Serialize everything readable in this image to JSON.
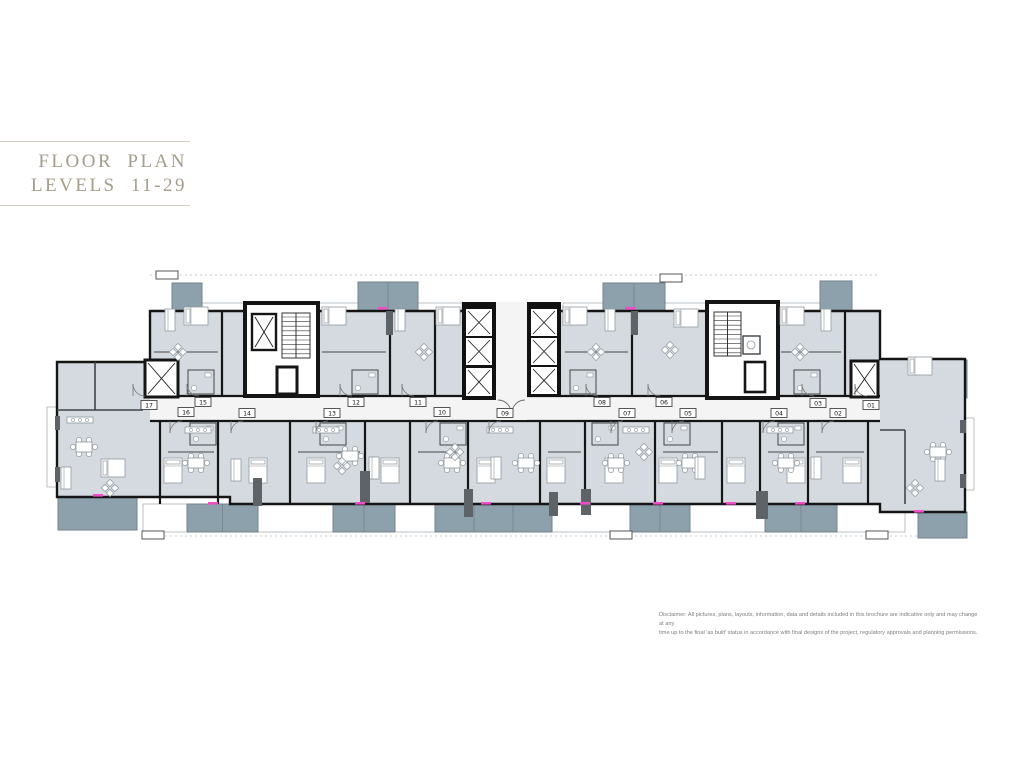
{
  "title": {
    "line1": "FLOOR  PLAN",
    "line2": "LEVELS 11-29"
  },
  "disclaimer": {
    "line1": "Disclaimer: All pictures, plans, layouts, information, data and details included in this brochure are indicative only and may change at any",
    "line2": "time up to the final 'as built' status in accordance with final designs of the project, regulatory approvals and planning permissions."
  },
  "colors": {
    "wall": "#151515",
    "room": "#d5dae0",
    "corridor": "#f4f4f5",
    "balcony": "#8da1ad",
    "balcony_edge": "#75838c",
    "white": "#ffffff",
    "thin_wall": "#3f4549",
    "furniture": "#8f989e",
    "pillar": "#5d6367",
    "pink": "#f04ec6",
    "title": "#a59c8b",
    "title_line": "#d5cec0",
    "disclaimer": "#7d7d7d",
    "dash": "#c6c9cb",
    "ledge_edge": "#aab2b7"
  },
  "plan": {
    "outline": "M150,311 H880 V359 H965 V512 H880 V504 H230 V497 H57 V362 H150 Z",
    "corridor": [
      150,
      396,
      730,
      25
    ],
    "dash_lines": [
      [
        150,
        275,
        880,
        275
      ],
      [
        145,
        536,
        965,
        536
      ]
    ],
    "walls_v_north": [
      222,
      390,
      435,
      632,
      845
    ],
    "walls_v_south": [
      160,
      218,
      290,
      365,
      410,
      468,
      540,
      585,
      655,
      722,
      760,
      808,
      868
    ],
    "walls_extra": [
      [
        57,
        410,
        143,
        410
      ],
      [
        95,
        362,
        95,
        410
      ],
      [
        905,
        430,
        905,
        504
      ],
      [
        880,
        430,
        905,
        430
      ]
    ],
    "partitions_h": [
      [
        154,
        352,
        218
      ],
      [
        322,
        352,
        386
      ],
      [
        565,
        352,
        628
      ],
      [
        781,
        352,
        841
      ],
      [
        168,
        452,
        214
      ],
      [
        298,
        452,
        360
      ],
      [
        418,
        452,
        464
      ],
      [
        548,
        452,
        581
      ],
      [
        663,
        452,
        718
      ],
      [
        768,
        452,
        804
      ],
      [
        816,
        452,
        864
      ]
    ],
    "baths": [
      [
        188,
        370,
        26,
        24
      ],
      [
        352,
        370,
        26,
        24
      ],
      [
        570,
        370,
        26,
        24
      ],
      [
        794,
        370,
        26,
        24
      ],
      [
        190,
        423,
        26,
        22
      ],
      [
        320,
        423,
        26,
        22
      ],
      [
        440,
        423,
        26,
        22
      ],
      [
        592,
        423,
        26,
        22
      ],
      [
        664,
        423,
        26,
        22
      ],
      [
        778,
        423,
        26,
        22
      ]
    ],
    "top_balconies": [
      [
        172,
        283,
        30,
        28,
        0
      ],
      [
        358,
        282,
        60,
        29,
        1
      ],
      [
        603,
        283,
        62,
        28,
        1
      ],
      [
        820,
        281,
        32,
        30,
        0
      ]
    ],
    "side_balconies": [
      [
        57,
        363,
        13,
        35
      ],
      [
        952,
        360,
        15,
        38
      ]
    ],
    "side_ledges": [
      [
        47,
        407,
        10,
        80
      ],
      [
        964,
        418,
        10,
        72
      ]
    ],
    "bottom_balconies": [
      [
        58,
        497,
        79,
        33,
        0
      ],
      [
        187,
        504,
        71,
        28,
        1
      ],
      [
        333,
        504,
        62,
        28,
        1
      ],
      [
        435,
        504,
        117,
        28,
        2
      ],
      [
        630,
        504,
        60,
        28,
        1
      ],
      [
        765,
        504,
        72,
        28,
        1
      ],
      [
        918,
        512,
        49,
        26,
        0
      ]
    ],
    "top_ledges": [
      [
        202,
        303,
        45,
        8
      ],
      [
        317,
        303,
        41,
        8
      ],
      [
        418,
        303,
        44,
        8
      ],
      [
        563,
        303,
        42,
        8
      ],
      [
        665,
        303,
        43,
        8
      ],
      [
        778,
        303,
        42,
        8
      ]
    ],
    "bottom_ledges": [
      [
        143,
        504,
        44,
        28
      ],
      [
        258,
        504,
        75,
        28
      ],
      [
        395,
        504,
        40,
        28
      ],
      [
        552,
        504,
        78,
        28
      ],
      [
        690,
        504,
        75,
        28
      ],
      [
        837,
        504,
        68,
        28
      ]
    ],
    "markers": [
      [
        156,
        271,
        22,
        8
      ],
      [
        660,
        274,
        22,
        8
      ],
      [
        142,
        531,
        22,
        8
      ],
      [
        610,
        531,
        22,
        8
      ],
      [
        866,
        531,
        22,
        8
      ]
    ],
    "cores": {
      "private_lift": [
        145,
        360,
        33,
        37
      ],
      "east_lift": [
        851,
        361,
        27,
        36
      ],
      "coreL": {
        "frame": [
          245,
          303,
          73,
          93
        ],
        "xcell": [
          252,
          314,
          24,
          36
        ],
        "stair": [
          282,
          313,
          28,
          45
        ],
        "shaft": [
          277,
          367,
          20,
          27
        ]
      },
      "towerL": {
        "frame": [
          462,
          302,
          34,
          98
        ],
        "cells": [
          [
            466,
            309,
            26,
            27
          ],
          [
            466,
            338,
            26,
            27
          ],
          [
            466,
            368,
            26,
            28
          ]
        ]
      },
      "towerR": {
        "frame": [
          527,
          302,
          34,
          95
        ],
        "cells": [
          [
            531,
            309,
            26,
            27
          ],
          [
            531,
            338,
            26,
            27
          ],
          [
            531,
            367,
            26,
            27
          ]
        ]
      },
      "lobby": [
        496,
        302,
        31,
        118
      ],
      "coreR": {
        "frame": [
          707,
          302,
          71,
          96
        ],
        "stair": [
          714,
          312,
          27,
          44
        ],
        "wc": [
          743,
          336,
          17,
          18
        ],
        "shaft": [
          745,
          362,
          20,
          30
        ]
      }
    },
    "pillars": [
      [
        386,
        311,
        7,
        24
      ],
      [
        631,
        311,
        7,
        24
      ],
      [
        253,
        478,
        9,
        28
      ],
      [
        360,
        471,
        10,
        32
      ],
      [
        464,
        489,
        9,
        28
      ],
      [
        549,
        492,
        9,
        24
      ],
      [
        581,
        489,
        10,
        26
      ],
      [
        756,
        491,
        12,
        28
      ],
      [
        55,
        416,
        5,
        14
      ],
      [
        55,
        467,
        5,
        15
      ],
      [
        960,
        420,
        6,
        13
      ],
      [
        960,
        474,
        6,
        14
      ]
    ],
    "pink_ticks": [
      [
        383,
        307
      ],
      [
        630,
        307
      ],
      [
        213,
        502
      ],
      [
        360,
        502
      ],
      [
        486,
        502
      ],
      [
        585,
        502
      ],
      [
        658,
        502
      ],
      [
        731,
        502
      ],
      [
        800,
        502
      ],
      [
        919,
        510
      ],
      [
        98,
        494
      ]
    ],
    "units": [
      {
        "id": "01",
        "x": 871,
        "y": 405,
        "row": "top"
      },
      {
        "id": "02",
        "x": 838,
        "y": 413,
        "row": "bottom"
      },
      {
        "id": "03",
        "x": 818,
        "y": 403,
        "row": "top"
      },
      {
        "id": "04",
        "x": 779,
        "y": 413,
        "row": "bottom"
      },
      {
        "id": "05",
        "x": 688,
        "y": 413,
        "row": "bottom"
      },
      {
        "id": "06",
        "x": 664,
        "y": 402,
        "row": "top"
      },
      {
        "id": "07",
        "x": 627,
        "y": 413,
        "row": "bottom"
      },
      {
        "id": "08",
        "x": 602,
        "y": 402,
        "row": "top"
      },
      {
        "id": "09",
        "x": 505,
        "y": 413,
        "row": "bottom"
      },
      {
        "id": "10",
        "x": 442,
        "y": 412,
        "row": "bottom"
      },
      {
        "id": "11",
        "x": 418,
        "y": 402,
        "row": "top"
      },
      {
        "id": "12",
        "x": 356,
        "y": 402,
        "row": "top"
      },
      {
        "id": "13",
        "x": 332,
        "y": 413,
        "row": "bottom"
      },
      {
        "id": "14",
        "x": 247,
        "y": 413,
        "row": "bottom"
      },
      {
        "id": "15",
        "x": 203,
        "y": 402,
        "row": "top"
      },
      {
        "id": "16",
        "x": 186,
        "y": 412,
        "row": "bottom"
      },
      {
        "id": "17",
        "x": 149,
        "y": 405,
        "row": "top"
      }
    ],
    "furniture": {
      "beds_h": [
        [
          196,
          316
        ],
        [
          334,
          316
        ],
        [
          448,
          316
        ],
        [
          575,
          316
        ],
        [
          686,
          318
        ],
        [
          792,
          316
        ],
        [
          920,
          366
        ],
        [
          113,
          468
        ]
      ],
      "beds_v": [
        [
          173,
          470
        ],
        [
          258,
          470
        ],
        [
          316,
          470
        ],
        [
          390,
          470
        ],
        [
          486,
          470
        ],
        [
          556,
          470
        ],
        [
          614,
          470
        ],
        [
          668,
          470
        ],
        [
          736,
          470
        ],
        [
          796,
          470
        ],
        [
          852,
          470
        ]
      ],
      "tables": [
        [
          84,
          447
        ],
        [
          196,
          463
        ],
        [
          350,
          456
        ],
        [
          452,
          463
        ],
        [
          526,
          463
        ],
        [
          616,
          463
        ],
        [
          690,
          463
        ],
        [
          786,
          463
        ],
        [
          938,
          452
        ]
      ],
      "sofas": [
        [
          170,
          320
        ],
        [
          400,
          320
        ],
        [
          610,
          320
        ],
        [
          826,
          320
        ],
        [
          66,
          478
        ],
        [
          236,
          470
        ],
        [
          374,
          468
        ],
        [
          496,
          468
        ],
        [
          700,
          468
        ],
        [
          816,
          468
        ],
        [
          940,
          470
        ]
      ],
      "diamonds": [
        [
          178,
          352
        ],
        [
          424,
          352
        ],
        [
          596,
          352
        ],
        [
          670,
          350
        ],
        [
          800,
          352
        ],
        [
          110,
          488
        ],
        [
          342,
          466
        ],
        [
          455,
          452
        ],
        [
          644,
          452
        ],
        [
          915,
          488
        ]
      ],
      "kitchens": [
        [
          198,
          430
        ],
        [
          326,
          430
        ],
        [
          500,
          430
        ],
        [
          636,
          430
        ],
        [
          780,
          430
        ],
        [
          80,
          420
        ]
      ]
    }
  }
}
